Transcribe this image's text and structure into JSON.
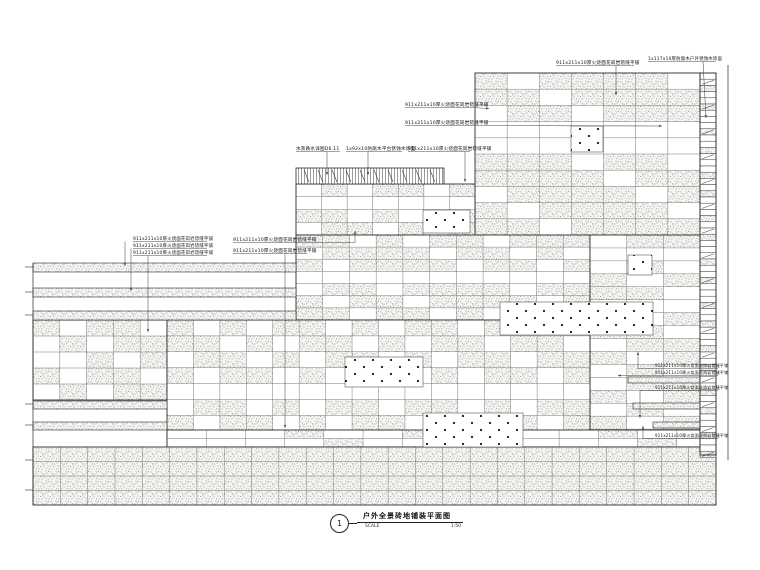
{
  "title_block": {
    "number": "1",
    "title": "户外全景砖地铺装平面图",
    "scale_label": "SCALE",
    "scale_value": "1:50"
  },
  "colors": {
    "bg": "#ffffff",
    "outline": "#2b2b2b",
    "grid": "#6b6b6b",
    "stipple_bg": "#f5f5f2",
    "stipple_dot": "#8c8c8c",
    "dot_fill": "#141414",
    "leader": "#4a4a4a",
    "text": "#111111"
  },
  "materials": {
    "granite_note": "911x211x10厚火烧面花岗岩错缝平铺",
    "wood_note": "1x117x10厚防腐木户外锈蚀木饰面",
    "water_note": "水景跌水详图D6.11",
    "deck_note": "1x92x10防腐木平台锈蚀木饰面"
  },
  "plan": {
    "width": 760,
    "height": 570,
    "grids": [
      {
        "name": "upper-terrace-grid",
        "x": 475,
        "y": 73,
        "w": 225,
        "h": 162,
        "cols": 7,
        "rows": 10,
        "density": 0.72,
        "seed": 3,
        "plainRows": [
          3,
          4
        ]
      },
      {
        "name": "mid-terrace-grid-a",
        "x": 296,
        "y": 184,
        "w": 179,
        "h": 51,
        "cols": 7,
        "rows": 4,
        "density": 0.6,
        "seed": 5,
        "plainRows": [
          1
        ]
      },
      {
        "name": "mid-terrace-grid-b",
        "x": 296,
        "y": 235,
        "w": 294,
        "h": 85,
        "cols": 11,
        "rows": 7,
        "density": 0.66,
        "seed": 7,
        "plainRows": [
          3
        ]
      },
      {
        "name": "right-terrace-grid",
        "x": 590,
        "y": 235,
        "w": 110,
        "h": 220,
        "cols": 3,
        "rows": 17,
        "density": 0.6,
        "seed": 4,
        "plainRows": [
          1,
          5
        ]
      },
      {
        "name": "lower-left-grid",
        "x": 33,
        "y": 320,
        "w": 134,
        "h": 80,
        "cols": 5,
        "rows": 5,
        "density": 0.55,
        "seed": 2,
        "plainRows": []
      },
      {
        "name": "lower-main-grid",
        "x": 167,
        "y": 320,
        "w": 423,
        "h": 127,
        "cols": 16,
        "rows": 8,
        "density": 0.62,
        "seed": 9,
        "plainRows": [
          4
        ]
      },
      {
        "name": "lower-thin-grid",
        "x": 167,
        "y": 430,
        "w": 549,
        "h": 17,
        "cols": 14,
        "rows": 2,
        "density": 0.22,
        "seed": 11,
        "plainRows": []
      },
      {
        "name": "bottom-steps-grid",
        "x": 33,
        "y": 447,
        "w": 683,
        "h": 58,
        "cols": 25,
        "rows": 4,
        "density": 1,
        "seed": 1,
        "plainRows": []
      }
    ],
    "bands": [
      {
        "x": 33,
        "y": 263,
        "w": 263,
        "h": 9
      },
      {
        "x": 33,
        "y": 288,
        "w": 263,
        "h": 9
      },
      {
        "x": 33,
        "y": 311,
        "w": 263,
        "h": 9
      },
      {
        "x": 33,
        "y": 401,
        "w": 134,
        "h": 8
      },
      {
        "x": 33,
        "y": 422,
        "w": 134,
        "h": 8
      },
      {
        "x": 628,
        "y": 377,
        "w": 88,
        "h": 6
      },
      {
        "x": 633,
        "y": 403,
        "w": 83,
        "h": 6
      },
      {
        "x": 653,
        "y": 422,
        "w": 63,
        "h": 6
      }
    ],
    "dot_rects": [
      {
        "x": 423,
        "y": 210,
        "w": 47,
        "h": 23
      },
      {
        "x": 571,
        "y": 126,
        "w": 32,
        "h": 26
      },
      {
        "x": 500,
        "y": 302,
        "w": 153,
        "h": 33
      },
      {
        "x": 345,
        "y": 357,
        "w": 78,
        "h": 30
      },
      {
        "x": 423,
        "y": 413,
        "w": 100,
        "h": 34
      },
      {
        "x": 628,
        "y": 255,
        "w": 24,
        "h": 20
      }
    ],
    "vhatch": {
      "x": 296,
      "y": 168,
      "w": 148,
      "h": 16
    },
    "ladder": {
      "x": 700,
      "y": 73,
      "w": 16,
      "h": 382,
      "slat": 6.2
    },
    "lines": [
      {
        "x1": 728,
        "y1": 65,
        "x2": 728,
        "y2": 460
      },
      {
        "x1": 33,
        "y1": 263,
        "x2": 33,
        "y2": 505
      }
    ],
    "ticks": [
      267,
      292,
      315,
      404,
      425,
      460,
      490
    ],
    "annotations": [
      {
        "key": "granite_note",
        "tx": 556,
        "ty": 64,
        "fs": 4.6,
        "ul": [
          556,
          634,
          65.5
        ],
        "leader": [
          [
            616,
            65.5
          ],
          [
            616,
            95
          ]
        ],
        "arrow": true
      },
      {
        "key": "wood_note",
        "tx": 648,
        "ty": 60,
        "fs": 4.4,
        "ul": [
          648,
          716,
          61.5
        ],
        "leader": [
          [
            703,
            61.5
          ],
          [
            706,
            118
          ]
        ],
        "arrow": true
      },
      {
        "key": "granite_note",
        "tx": 405,
        "ty": 106,
        "fs": 4.6,
        "ul": [
          405,
          472,
          107.5
        ],
        "leader": [
          [
            472,
            107.5
          ],
          [
            489,
            108.5
          ]
        ],
        "arrow": true
      },
      {
        "key": "granite_note",
        "tx": 405,
        "ty": 124,
        "fs": 4.6,
        "ul": [
          405,
          472,
          125.5
        ],
        "leader": [
          [
            472,
            125.5
          ],
          [
            662,
            126
          ]
        ],
        "arrow": true
      },
      {
        "key": "water_note",
        "tx": 296,
        "ty": 150,
        "fs": 4.6,
        "ul": [
          296,
          340,
          151.5
        ],
        "leader": [
          [
            327,
            151.5
          ],
          [
            327,
            175
          ]
        ],
        "arrow": true
      },
      {
        "key": "deck_note",
        "tx": 346,
        "ty": 150,
        "fs": 4.6,
        "ul": [
          346,
          402,
          151.5
        ],
        "leader": [
          [
            368,
            151.5
          ],
          [
            368,
            175
          ]
        ],
        "arrow": true
      },
      {
        "key": "granite_note",
        "tx": 408,
        "ty": 150,
        "fs": 4.6,
        "ul": [
          408,
          470,
          151.5
        ],
        "leader": [
          [
            465,
            151.5
          ],
          [
            465,
            182
          ]
        ],
        "arrow": true
      },
      {
        "key": "granite_note",
        "tx": 133,
        "ty": 240,
        "fs": 4.4,
        "ul": [
          133,
          207,
          241.5
        ],
        "leader": [
          [
            125,
            241.5
          ],
          [
            125,
            266
          ]
        ],
        "arrow": true
      },
      {
        "key": "granite_note",
        "tx": 133,
        "ty": 247,
        "fs": 4.4,
        "ul": [
          133,
          207,
          248.5
        ],
        "leader": [
          [
            131,
            248.5
          ],
          [
            131,
            291
          ]
        ],
        "arrow": true
      },
      {
        "key": "granite_note",
        "tx": 133,
        "ty": 254,
        "fs": 4.4,
        "ul": [
          133,
          207,
          255.5
        ],
        "leader": [
          [
            148,
            255.5
          ],
          [
            148,
            332
          ]
        ],
        "arrow": true
      },
      {
        "key": "granite_note",
        "tx": 233,
        "ty": 241,
        "fs": 4.6,
        "ul": [
          233,
          307,
          242.5
        ],
        "leader": [
          [
            307,
            242.5
          ],
          [
            355,
            242.5
          ],
          [
            355,
            231
          ]
        ],
        "arrow": true
      },
      {
        "key": "granite_note",
        "tx": 233,
        "ty": 252,
        "fs": 4.6,
        "ul": [
          233,
          307,
          253.5
        ],
        "leader": [
          [
            285,
            253.5
          ],
          [
            285,
            428
          ]
        ],
        "arrow": true
      },
      {
        "key": "granite_note",
        "tx": 655,
        "ty": 367,
        "fs": 4.0,
        "ul": [
          648,
          718,
          368.5
        ],
        "leader": [
          [
            648,
            368.5
          ],
          [
            638,
            368.5
          ],
          [
            638,
            352
          ]
        ],
        "arrow": true
      },
      {
        "key": "granite_note",
        "tx": 655,
        "ty": 374,
        "fs": 4.0,
        "ul": [
          648,
          718,
          375.5
        ],
        "leader": [
          [
            648,
            375.5
          ],
          [
            618,
            375.5
          ]
        ],
        "arrow": true
      },
      {
        "key": "granite_note",
        "tx": 655,
        "ty": 389,
        "fs": 4.0,
        "ul": [
          648,
          718,
          390.5
        ],
        "leader": [
          [
            648,
            390.5
          ],
          [
            640,
            390.5
          ],
          [
            640,
            418
          ]
        ],
        "arrow": true
      },
      {
        "key": "granite_note",
        "tx": 655,
        "ty": 437,
        "fs": 4.0,
        "ul": [
          648,
          718,
          438.5
        ],
        "leader": [
          [
            648,
            438.5
          ],
          [
            643,
            438.5
          ],
          [
            643,
            426
          ]
        ],
        "arrow": true
      }
    ]
  }
}
